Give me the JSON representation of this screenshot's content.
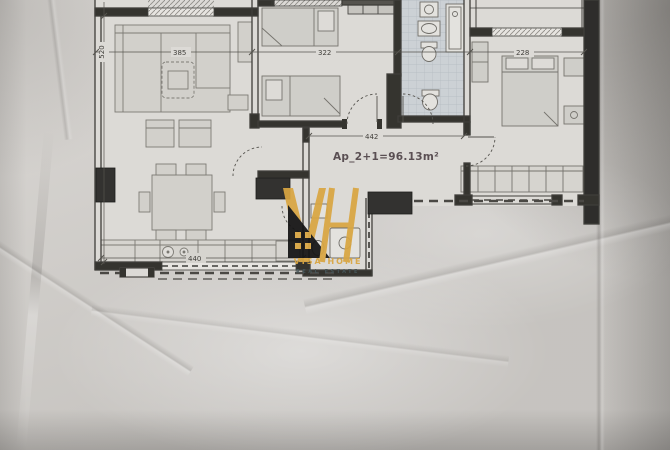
{
  "plan": {
    "area_label": "Ap_2+1=96.13m²",
    "dimensions": {
      "left_height": "520",
      "living_width": "385",
      "bedroom_mid_width": "322",
      "bedroom_right_width": "228",
      "hall_width": "442",
      "kitchen_width": "440"
    }
  },
  "logo": {
    "monogram": "VH",
    "name": "VISA HOME",
    "tagline": "REAL ESTATE"
  },
  "colors": {
    "gold": "#d9a642",
    "paper": "#d5d2ce",
    "ink": "#3f3e3a",
    "tile": "#ccd1d5",
    "dark_wall": "#2e2d2b"
  }
}
